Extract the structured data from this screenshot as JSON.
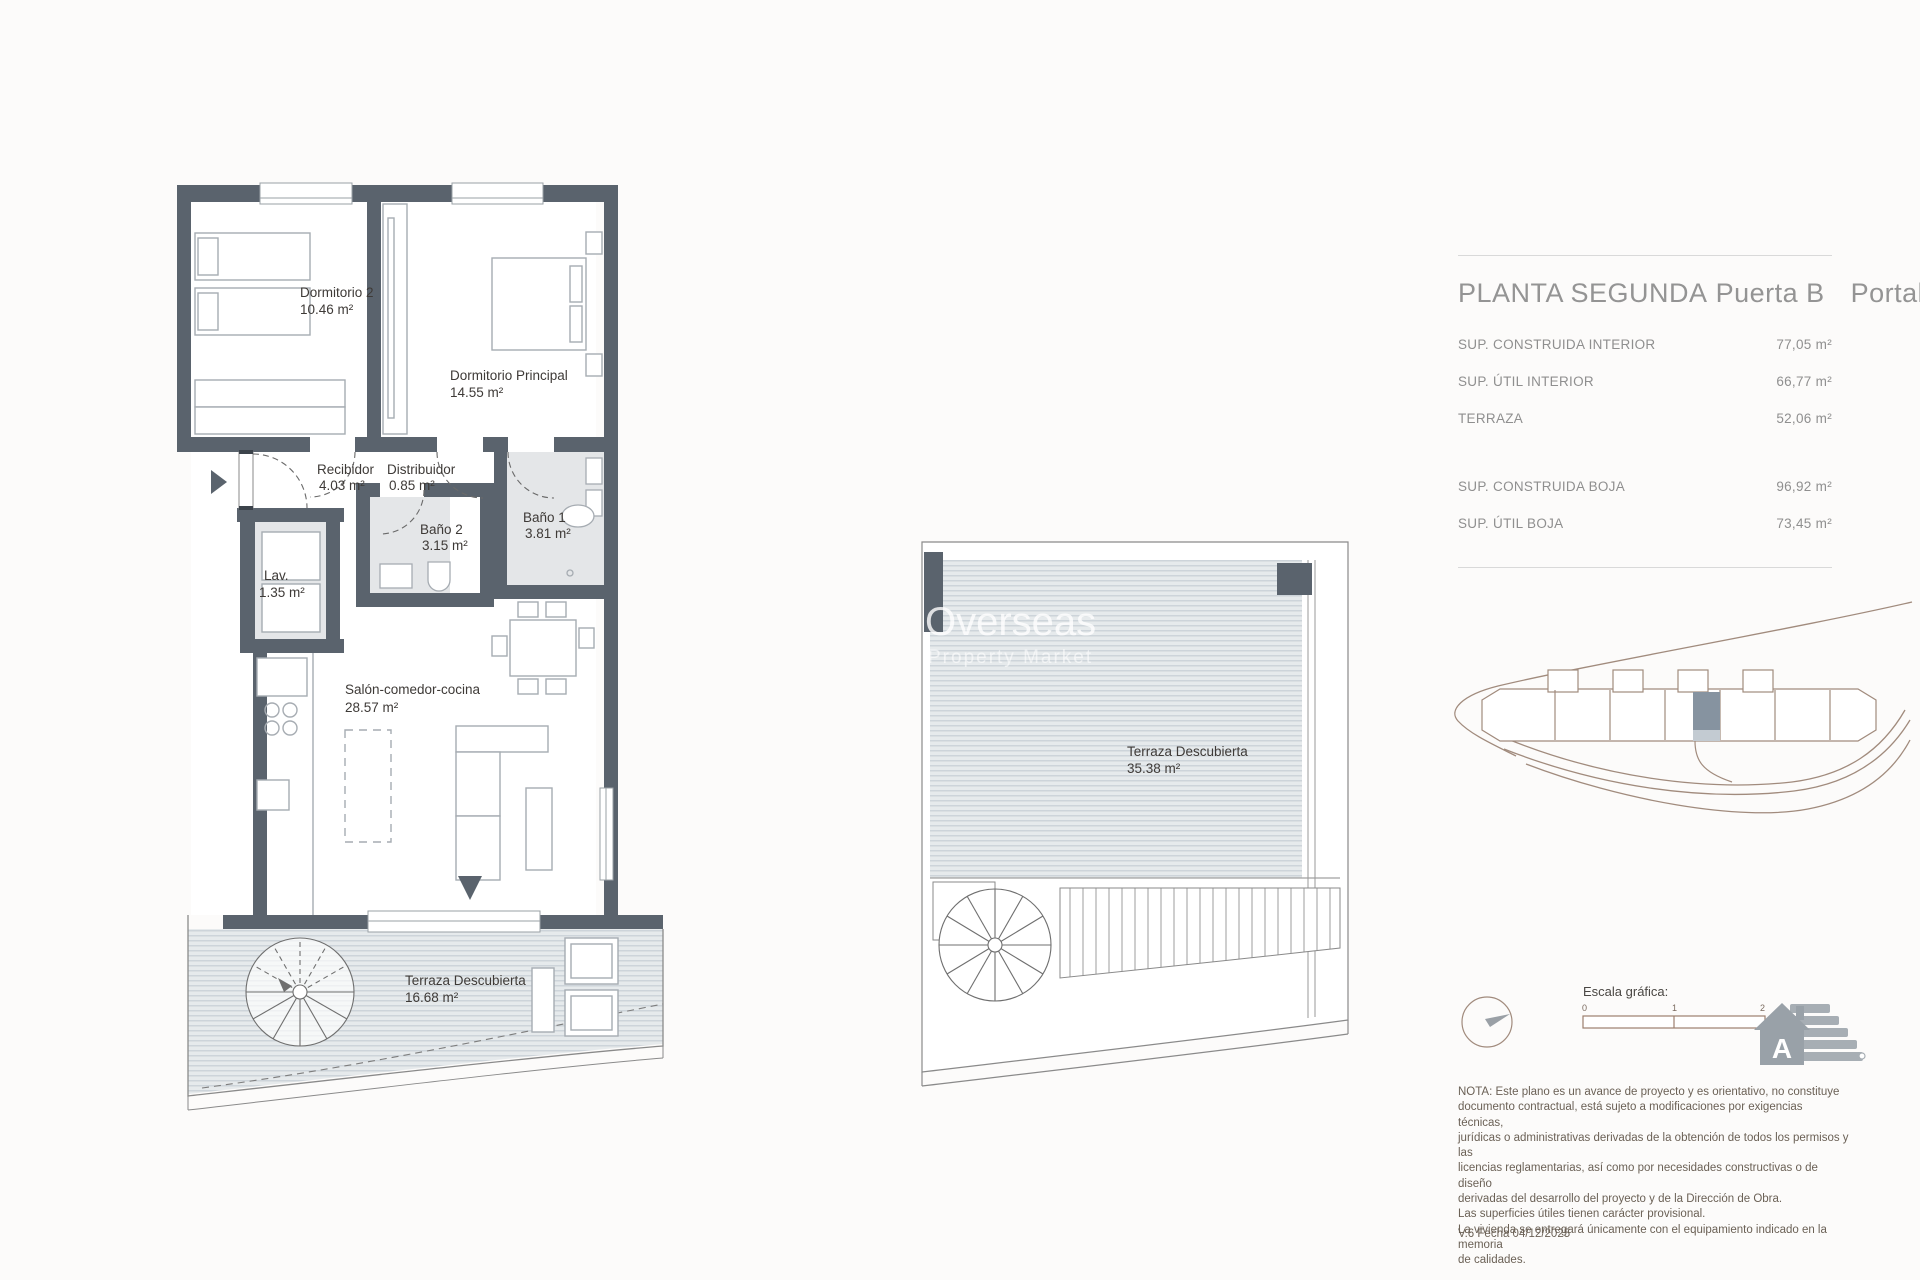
{
  "panel": {
    "title": {
      "part1": "PLANTA SEGUNDA",
      "part2": "Puerta B",
      "part3": "Portal 3"
    },
    "areas": [
      {
        "label": "SUP. CONSTRUIDA INTERIOR",
        "value": "77,05 m²"
      },
      {
        "label": "SUP. ÚTIL INTERIOR",
        "value": "66,77 m²"
      },
      {
        "label": "TERRAZA",
        "value": "52,06 m²"
      },
      {
        "label": "SUP. CONSTRUIDA BOJA",
        "value": "96,92 m²"
      },
      {
        "label": "SUP. ÚTIL BOJA",
        "value": "73,45 m²"
      }
    ],
    "escala": {
      "label": "Escala gráfica:",
      "ticks": [
        "0",
        "1",
        "2"
      ]
    },
    "energy_rating": "A",
    "note_lines": [
      "NOTA: Este plano es un avance de proyecto y es orientativo, no constituye",
      "documento contractual, está sujeto a modificaciones por exigencias técnicas,",
      "jurídicas o administrativas derivadas de la obtención de todos los permisos y las",
      "licencias reglamentarias, así como por necesidades constructivas o de diseño",
      "derivadas del desarrollo del proyecto y de la Dirección de Obra.",
      "Las superficies útiles tienen carácter provisional.",
      "La vivienda se entregará únicamente con el equipamiento indicado en la memoria",
      "de calidades."
    ],
    "version": "V.6 Fecha 04/12/2025"
  },
  "plan": {
    "rooms": {
      "dormitorio2": {
        "name": "Dormitorio 2",
        "area": "10.46 m²"
      },
      "dormitorio_principal": {
        "name": "Dormitorio Principal",
        "area": "14.55 m²"
      },
      "recibidor": {
        "name": "Recibidor",
        "area": "4.03 m²"
      },
      "distribuidor": {
        "name": "Distribuidor",
        "area": "0.85 m²"
      },
      "bano1": {
        "name": "Baño 1",
        "area": "3.81 m²"
      },
      "bano2": {
        "name": "Baño 2",
        "area": "3.15 m²"
      },
      "lavadero": {
        "name": "Lav.",
        "area": "1.35 m²"
      },
      "salon": {
        "name": "Salón-comedor-cocina",
        "area": "28.57 m²"
      },
      "terraza": {
        "name": "Terraza Descubierta",
        "area": "16.68 m²"
      }
    }
  },
  "roof": {
    "terraza": {
      "name": "Terraza Descubierta",
      "area": "35.38 m²"
    }
  },
  "watermark": {
    "line1": "Overseas",
    "line2": "Property Market"
  },
  "colors": {
    "wall": "#5a636d",
    "bath_floor": "#e4e6e8",
    "deck_base": "#e6eaec",
    "deck_line": "#c7cfd5",
    "furniture_line": "#a6acb2",
    "label_text": "#3e3a37",
    "panel_text": "#8f8f8f",
    "note_text": "#6b6156",
    "site_line": "#a18b7d",
    "highlight_unit": "#8693a0"
  }
}
